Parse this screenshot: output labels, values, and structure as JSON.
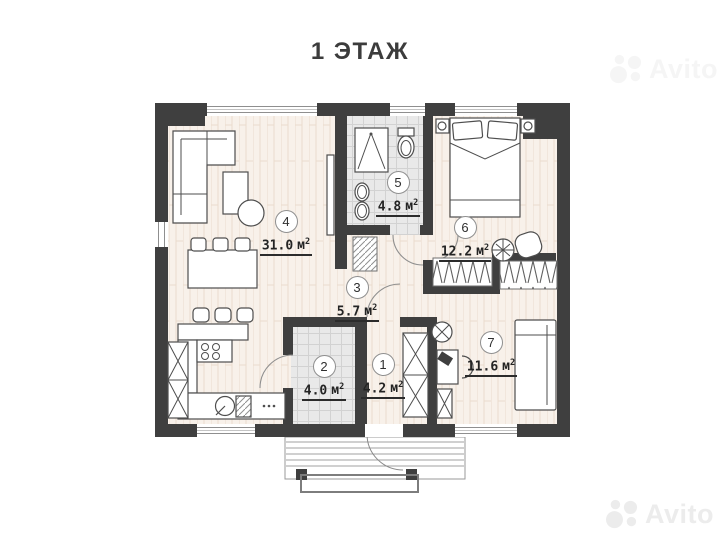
{
  "title": "1 ЭТАЖ",
  "watermark": {
    "brand": "Avito"
  },
  "rooms": [
    {
      "number": "1",
      "area_value": "4.2",
      "area_unit": "м",
      "area_sup": "2"
    },
    {
      "number": "2",
      "area_value": "4.0",
      "area_unit": "м",
      "area_sup": "2"
    },
    {
      "number": "3",
      "area_value": "5.7",
      "area_unit": "м",
      "area_sup": "2"
    },
    {
      "number": "4",
      "area_value": "31.0",
      "area_unit": "м",
      "area_sup": "2"
    },
    {
      "number": "5",
      "area_value": "4.8",
      "area_unit": "м",
      "area_sup": "2"
    },
    {
      "number": "6",
      "area_value": "12.2",
      "area_unit": "м",
      "area_sup": "2"
    },
    {
      "number": "7",
      "area_value": "11.6",
      "area_unit": "м",
      "area_sup": "2"
    }
  ],
  "colors": {
    "wall": "#3f3f3f",
    "wood_floor": "#f8f1ea",
    "tile_floor": "#e9e9e9",
    "label_text": "#242424",
    "watermark": "#ececec"
  }
}
